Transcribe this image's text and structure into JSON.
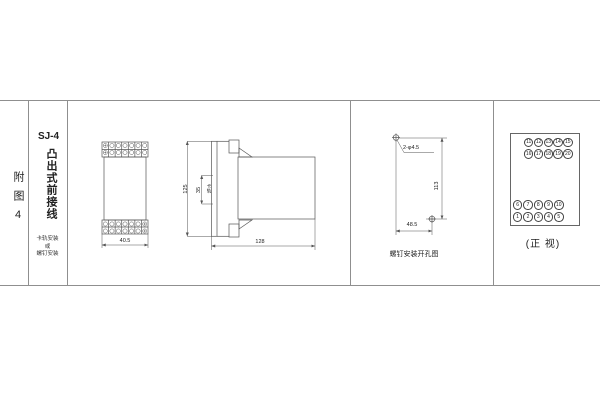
{
  "page": {
    "bg": "#ffffff",
    "line_color": "#8f8f8f",
    "draw_color": "#555555"
  },
  "left_panel": {
    "figure_label": "附图4",
    "model": "SJ-4",
    "wiring_type": "凸出式前接线",
    "mount_lines": [
      "卡轨安装",
      "或",
      "螺钉安装"
    ]
  },
  "front_dim_view": {
    "width": "40.5"
  },
  "side_view": {
    "height": "125",
    "rail_height": "35",
    "rail_label": "卡轨",
    "depth": "128"
  },
  "hole_diagram": {
    "holes": "2-φ4.5",
    "height": "113",
    "width": "48.5",
    "caption": "螺钉安装开孔图"
  },
  "front_view": {
    "caption": "(正 视)",
    "rows": {
      "top1": [
        "11",
        "12",
        "13",
        "14",
        "15"
      ],
      "top2": [
        "16",
        "17",
        "18",
        "19",
        "20"
      ],
      "bottom1": [
        "6",
        "7",
        "8",
        "9",
        "10"
      ],
      "bottom2": [
        "1",
        "2",
        "3",
        "4",
        "5"
      ]
    }
  }
}
